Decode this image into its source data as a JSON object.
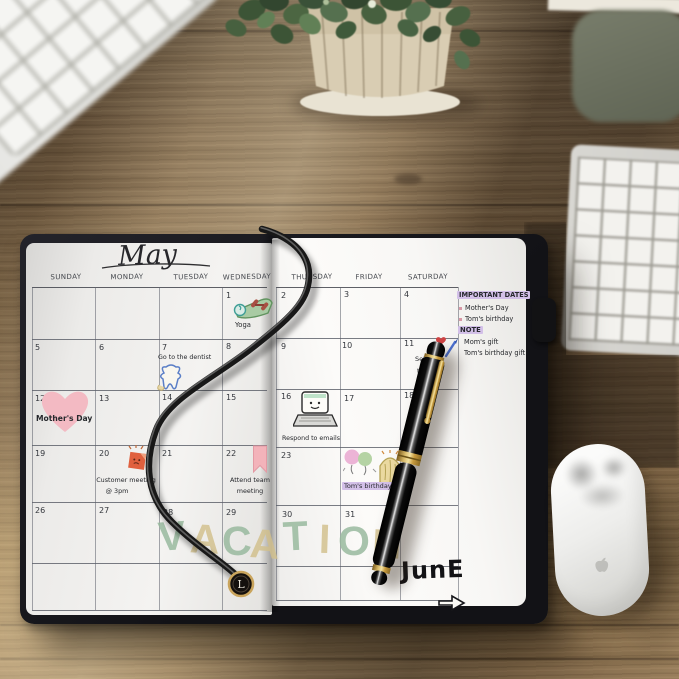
{
  "planner": {
    "month_title": "May",
    "weekday_headers": [
      "SUNDAY",
      "MONDAY",
      "TUESDAY",
      "WEDNESDAY",
      "THURSDAY",
      "FRIDAY",
      "SATURDAY"
    ],
    "day_numbers": [
      "1",
      "2",
      "3",
      "4",
      "5",
      "6",
      "7",
      "8",
      "9",
      "10",
      "11",
      "12",
      "13",
      "14",
      "15",
      "16",
      "17",
      "18",
      "19",
      "20",
      "21",
      "22",
      "23",
      "24",
      "26",
      "27",
      "28",
      "29",
      "30",
      "31"
    ],
    "events": {
      "yoga": {
        "label": "Yoga"
      },
      "dentist": {
        "label": "Go to the dentist"
      },
      "mothers_day": {
        "label": "Mother's Day"
      },
      "goals": {
        "line1": "Set g",
        "line2": "the"
      },
      "emails": {
        "label": "Respond to emails"
      },
      "customer_meeting": {
        "line1": "Customer meeting",
        "line2": "@ 3pm"
      },
      "team_meeting": {
        "line1": "Attend team",
        "line2": "meeting"
      },
      "birthday": {
        "label": "Tom's birthday"
      }
    },
    "vacation_letters": [
      {
        "ch": "V",
        "color": "#96b89c"
      },
      {
        "ch": "A",
        "color": "#d2c08c"
      },
      {
        "ch": "C",
        "color": "#96b89c"
      },
      {
        "ch": "A",
        "color": "#d2c08c"
      },
      {
        "ch": "T",
        "color": "#96b89c"
      },
      {
        "ch": "I",
        "color": "#d2c08c"
      },
      {
        "ch": "O",
        "color": "#96b89c"
      },
      {
        "ch": "N",
        "color": "#d2c08c"
      }
    ],
    "june_note": "JunE",
    "sidebar": {
      "important_title": "IMPORTANT DATES",
      "important_items": [
        "Mother's Day",
        "Tom's birthday"
      ],
      "note_title": "NOTE",
      "note_items": [
        "Mom's gift",
        "Tom's birthday gift"
      ]
    },
    "bookmark_monogram": "L"
  },
  "colors": {
    "highlight": "#d3c0e8",
    "bullet_pink": "#d898a6",
    "heart_pink": "#f3bac3",
    "cover_black": "#17171a",
    "pen_gold": "#c9a14f"
  }
}
